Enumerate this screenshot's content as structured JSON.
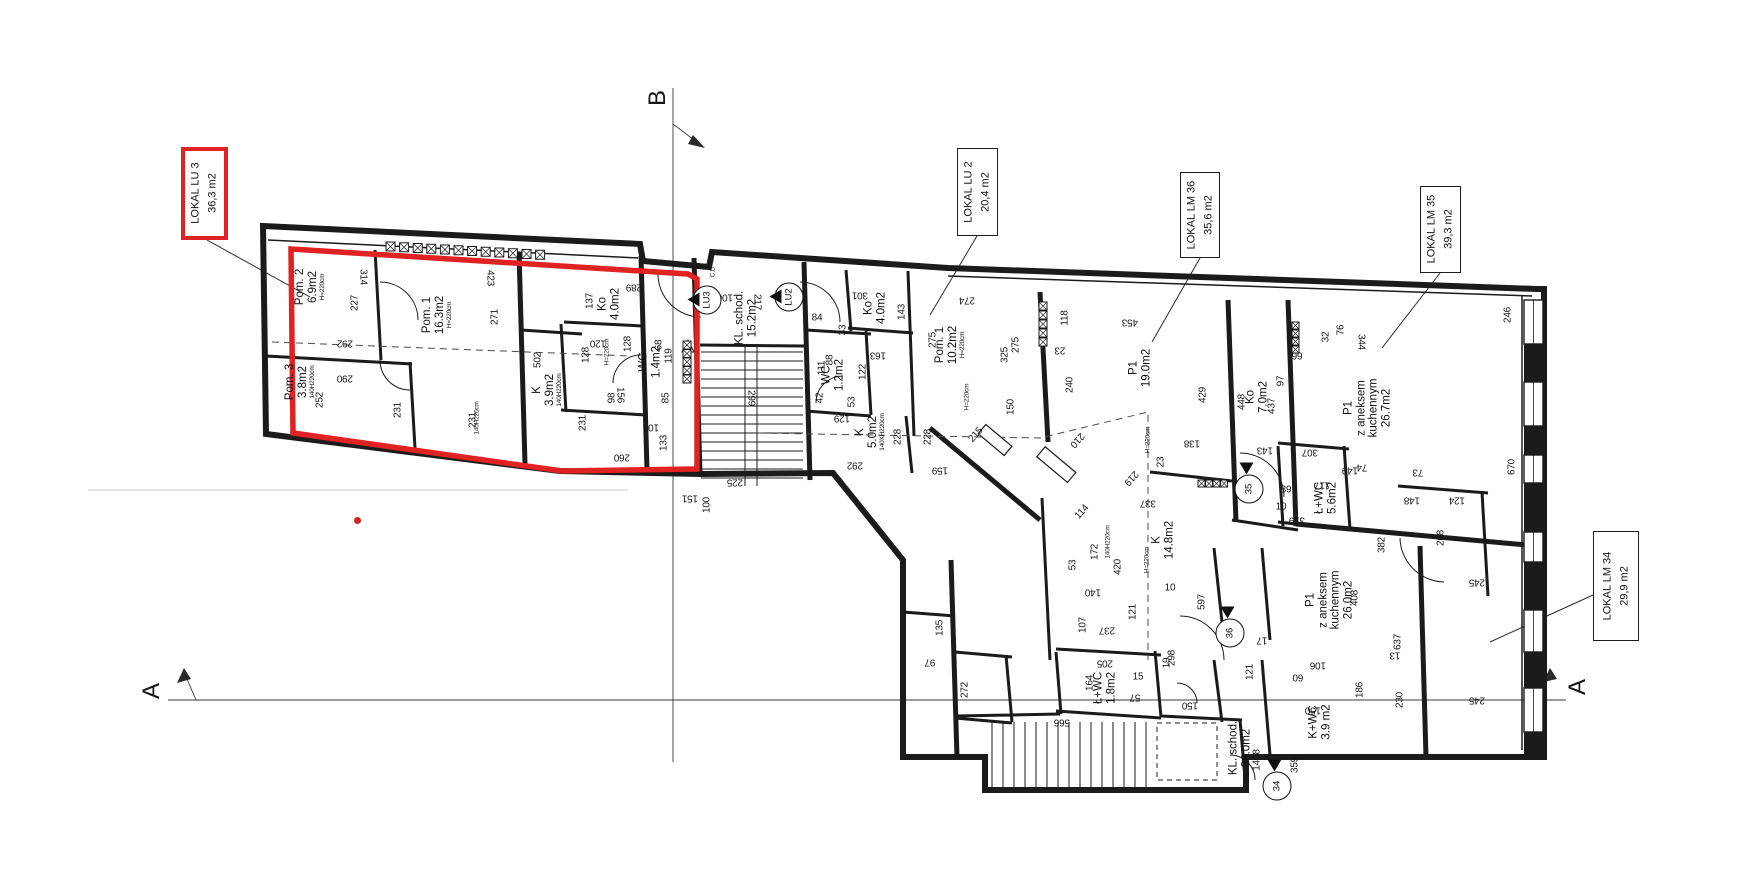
{
  "palette": {
    "line": "#1b1b1b",
    "red": "#e02222",
    "faint": "#c8c8c8"
  },
  "section_marks": {
    "top": "B",
    "left": "A",
    "right": "A"
  },
  "title_boxes": [
    {
      "id": "lu3",
      "lines": [
        "LOKAL LU 3",
        "36,3 m2"
      ],
      "x": 181,
      "y": 147,
      "w": 47,
      "h": 93,
      "red": true
    },
    {
      "id": "lu2",
      "lines": [
        "LOKAL LU 2",
        "20,4 m2"
      ],
      "x": 957,
      "y": 148,
      "w": 41,
      "h": 88,
      "red": false
    },
    {
      "id": "lm36",
      "lines": [
        "LOKAL LM 36",
        "35,6 m2"
      ],
      "x": 1180,
      "y": 172,
      "w": 40,
      "h": 86,
      "red": false
    },
    {
      "id": "lm35",
      "lines": [
        "LOKAL LM 35",
        "39,3 m2"
      ],
      "x": 1420,
      "y": 186,
      "w": 41,
      "h": 87,
      "red": false
    },
    {
      "id": "lm34",
      "lines": [
        "LOKAL LM 34",
        "29,9 m2"
      ],
      "x": 1593,
      "y": 531,
      "w": 46,
      "h": 110,
      "red": false
    }
  ],
  "rooms": [
    {
      "lines": [
        "Pom. 2",
        "6.9m2"
      ],
      "note": "H=220cm",
      "x": 310,
      "y": 287
    },
    {
      "lines": [
        "Pom. 1",
        "16.3m2"
      ],
      "note": "H=220cm",
      "x": 437,
      "y": 315
    },
    {
      "lines": [
        "Pom. 3",
        "3.8m2"
      ],
      "note": "140H220cm",
      "x": 300,
      "y": 382
    },
    {
      "lines": [
        "Ko",
        "4.0m2"
      ],
      "x": 609,
      "y": 304
    },
    {
      "lines": [
        "WC",
        "1.4m2"
      ],
      "x": 650,
      "y": 362
    },
    {
      "lines": [
        "K",
        "3.9m2"
      ],
      "note": "140H220cm",
      "x": 547,
      "y": 390
    },
    {
      "lines": [
        "KL. schod.",
        "15.2m2"
      ],
      "x": 746,
      "y": 318
    },
    {
      "lines": [
        "Ko",
        "4.0m2"
      ],
      "x": 875,
      "y": 308
    },
    {
      "lines": [
        "WC",
        "1.2m2"
      ],
      "x": 833,
      "y": 375
    },
    {
      "lines": [
        "K",
        "5.0m2"
      ],
      "note": "140XH220cm",
      "x": 870,
      "y": 432
    },
    {
      "lines": [
        "Pom. 1",
        "10.2m2"
      ],
      "note": "H=220cm",
      "x": 950,
      "y": 345
    },
    {
      "lines": [
        "P1",
        "19.0m2"
      ],
      "x": 1140,
      "y": 368
    },
    {
      "lines": [
        "Ko",
        "7.0m2"
      ],
      "x": 1257,
      "y": 397
    },
    {
      "lines": [
        "P1",
        "z aneksem",
        "kuchennym",
        "26.7m2"
      ],
      "x": 1368,
      "y": 408
    },
    {
      "lines": [
        "K",
        "14.8m2"
      ],
      "x": 1163,
      "y": 540
    },
    {
      "lines": [
        "Ł+WC",
        "1.8m2"
      ],
      "x": 1105,
      "y": 688
    },
    {
      "lines": [
        "Ł+WC",
        "5.6m2"
      ],
      "x": 1326,
      "y": 498
    },
    {
      "lines": [
        "KL. schod.",
        "36.0m2"
      ],
      "x": 1240,
      "y": 748
    },
    {
      "lines": [
        "P1",
        "z aneksem",
        "kuchennym",
        "26.0m2"
      ],
      "x": 1330,
      "y": 600
    },
    {
      "lines": [
        "K+WC",
        "3.9 m2"
      ],
      "x": 1320,
      "y": 722
    }
  ],
  "markers": [
    {
      "label": "LU3",
      "x": 707,
      "y": 300,
      "tri": "left"
    },
    {
      "label": "LU2",
      "x": 789,
      "y": 297,
      "tri": "left"
    },
    {
      "label": "35",
      "x": 1249,
      "y": 489,
      "tri": "top"
    },
    {
      "label": "36",
      "x": 1230,
      "y": 633,
      "tri": "top"
    },
    {
      "label": "34",
      "x": 1277,
      "y": 786,
      "tri": "top"
    }
  ],
  "dims": [
    {
      "v": "314",
      "x": 363,
      "y": 277,
      "r": 90
    },
    {
      "v": "423",
      "x": 490,
      "y": 278,
      "r": 90
    },
    {
      "v": "227",
      "x": 355,
      "y": 303,
      "r": -90
    },
    {
      "v": "292",
      "x": 345,
      "y": 343,
      "r": 180
    },
    {
      "v": "290",
      "x": 345,
      "y": 378,
      "r": 180
    },
    {
      "v": "252",
      "x": 320,
      "y": 400,
      "r": -90
    },
    {
      "v": "231",
      "x": 398,
      "y": 410,
      "r": -90
    },
    {
      "v": "231",
      "x": 473,
      "y": 420,
      "r": -90
    },
    {
      "v": "231",
      "x": 583,
      "y": 423,
      "r": -90
    },
    {
      "v": "271",
      "x": 495,
      "y": 317,
      "r": -90
    },
    {
      "v": "502",
      "x": 538,
      "y": 360,
      "r": -90
    },
    {
      "v": "137",
      "x": 590,
      "y": 301,
      "r": -90
    },
    {
      "v": "128",
      "x": 586,
      "y": 355,
      "r": -90
    },
    {
      "v": "128",
      "x": 628,
      "y": 344,
      "r": -90
    },
    {
      "v": "120",
      "x": 598,
      "y": 343,
      "r": 180
    },
    {
      "v": "289",
      "x": 634,
      "y": 287,
      "r": 180
    },
    {
      "v": "68",
      "x": 659,
      "y": 345,
      "r": -90
    },
    {
      "v": "119",
      "x": 669,
      "y": 356,
      "r": -90
    },
    {
      "v": "156",
      "x": 620,
      "y": 395,
      "r": 90
    },
    {
      "v": "98",
      "x": 612,
      "y": 398,
      "r": -90
    },
    {
      "v": "85",
      "x": 666,
      "y": 398,
      "r": -90
    },
    {
      "v": "104",
      "x": 651,
      "y": 427,
      "r": 180
    },
    {
      "v": "133",
      "x": 664,
      "y": 443,
      "r": -90
    },
    {
      "v": "260",
      "x": 622,
      "y": 457,
      "r": 180
    },
    {
      "v": "225",
      "x": 735,
      "y": 482,
      "r": 180
    },
    {
      "v": "151",
      "x": 690,
      "y": 498,
      "r": 180
    },
    {
      "v": "100",
      "x": 707,
      "y": 505,
      "r": -90
    },
    {
      "v": "299",
      "x": 751,
      "y": 398,
      "r": 90
    },
    {
      "v": "106",
      "x": 725,
      "y": 297,
      "r": 180
    },
    {
      "v": "217",
      "x": 757,
      "y": 302,
      "r": 90
    },
    {
      "v": "C,D",
      "x": 713,
      "y": 272,
      "r": -90,
      "s": 1
    },
    {
      "v": "84",
      "x": 817,
      "y": 318,
      "r": 0
    },
    {
      "v": "301",
      "x": 860,
      "y": 295,
      "r": 180
    },
    {
      "v": "143",
      "x": 902,
      "y": 312,
      "r": -90
    },
    {
      "v": "33",
      "x": 843,
      "y": 330,
      "r": -90
    },
    {
      "v": "88",
      "x": 830,
      "y": 360,
      "r": -90
    },
    {
      "v": "111",
      "x": 822,
      "y": 368,
      "r": -90
    },
    {
      "v": "122",
      "x": 863,
      "y": 372,
      "r": -90
    },
    {
      "v": "163",
      "x": 878,
      "y": 355,
      "r": 180
    },
    {
      "v": "42",
      "x": 820,
      "y": 398,
      "r": -90
    },
    {
      "v": "53",
      "x": 852,
      "y": 402,
      "r": -90
    },
    {
      "v": "129",
      "x": 842,
      "y": 418,
      "r": 180
    },
    {
      "v": "150",
      "x": 1011,
      "y": 407,
      "r": -90
    },
    {
      "v": "228",
      "x": 898,
      "y": 437,
      "r": -90
    },
    {
      "v": "228",
      "x": 928,
      "y": 437,
      "r": -90
    },
    {
      "v": "292",
      "x": 855,
      "y": 465,
      "r": 180
    },
    {
      "v": "275",
      "x": 933,
      "y": 340,
      "r": -90
    },
    {
      "v": "275",
      "x": 1016,
      "y": 345,
      "r": -90
    },
    {
      "v": "274",
      "x": 967,
      "y": 300,
      "r": 180
    },
    {
      "v": "325",
      "x": 1005,
      "y": 355,
      "r": -90
    },
    {
      "v": "215",
      "x": 976,
      "y": 435,
      "r": -48
    },
    {
      "v": "240",
      "x": 1070,
      "y": 385,
      "r": -90
    },
    {
      "v": "210",
      "x": 1077,
      "y": 440,
      "r": 132
    },
    {
      "v": "118",
      "x": 1065,
      "y": 318,
      "r": -90
    },
    {
      "v": "23",
      "x": 1060,
      "y": 350,
      "r": 180
    },
    {
      "v": "159",
      "x": 940,
      "y": 470,
      "r": 180
    },
    {
      "v": "453",
      "x": 1130,
      "y": 322,
      "r": 180
    },
    {
      "v": "429",
      "x": 1203,
      "y": 395,
      "r": -90
    },
    {
      "v": "138",
      "x": 1192,
      "y": 443,
      "r": 180
    },
    {
      "v": "23",
      "x": 1161,
      "y": 462,
      "r": -90
    },
    {
      "v": "219",
      "x": 1131,
      "y": 478,
      "r": 132
    },
    {
      "v": "448",
      "x": 1242,
      "y": 402,
      "r": -90
    },
    {
      "v": "437",
      "x": 1272,
      "y": 406,
      "r": -90
    },
    {
      "v": "97",
      "x": 1281,
      "y": 381,
      "r": -90
    },
    {
      "v": "143",
      "x": 1265,
      "y": 450,
      "r": 180
    },
    {
      "v": "99",
      "x": 1297,
      "y": 357,
      "r": 0
    },
    {
      "v": "32",
      "x": 1326,
      "y": 337,
      "r": -90
    },
    {
      "v": "76",
      "x": 1341,
      "y": 330,
      "r": -90
    },
    {
      "v": "344",
      "x": 1361,
      "y": 342,
      "r": 90
    },
    {
      "v": "114",
      "x": 1082,
      "y": 512,
      "r": -48
    },
    {
      "v": "172",
      "x": 1095,
      "y": 552,
      "r": -90
    },
    {
      "v": "420",
      "x": 1118,
      "y": 567,
      "r": -90
    },
    {
      "v": "140",
      "x": 1093,
      "y": 592,
      "r": 180
    },
    {
      "v": "53",
      "x": 1073,
      "y": 565,
      "r": -90
    },
    {
      "v": "107",
      "x": 1083,
      "y": 625,
      "r": -90
    },
    {
      "v": "237",
      "x": 1107,
      "y": 630,
      "r": 180
    },
    {
      "v": "121",
      "x": 1133,
      "y": 612,
      "r": -90
    },
    {
      "v": "337",
      "x": 1148,
      "y": 503,
      "r": 180
    },
    {
      "v": "597",
      "x": 1202,
      "y": 602,
      "r": -90
    },
    {
      "v": "10",
      "x": 1170,
      "y": 588,
      "r": 0
    },
    {
      "v": "19",
      "x": 1167,
      "y": 663,
      "r": -90
    },
    {
      "v": "298",
      "x": 1172,
      "y": 658,
      "r": -90
    },
    {
      "v": "205",
      "x": 1105,
      "y": 663,
      "r": 180
    },
    {
      "v": "164",
      "x": 1090,
      "y": 683,
      "r": -90
    },
    {
      "v": "15",
      "x": 1138,
      "y": 677,
      "r": 0
    },
    {
      "v": "57",
      "x": 1135,
      "y": 697,
      "r": 180
    },
    {
      "v": "150",
      "x": 1190,
      "y": 705,
      "r": 180
    },
    {
      "v": "121",
      "x": 1250,
      "y": 672,
      "r": -90
    },
    {
      "v": "17",
      "x": 1262,
      "y": 640,
      "r": 180
    },
    {
      "v": "106",
      "x": 1318,
      "y": 665,
      "r": 180
    },
    {
      "v": "60",
      "x": 1298,
      "y": 677,
      "r": 180
    },
    {
      "v": "150",
      "x": 1313,
      "y": 710,
      "r": 180
    },
    {
      "v": "359",
      "x": 1295,
      "y": 765,
      "r": -90
    },
    {
      "v": "1408",
      "x": 1257,
      "y": 760,
      "r": -90
    },
    {
      "v": "135",
      "x": 940,
      "y": 628,
      "r": -90
    },
    {
      "v": "97",
      "x": 930,
      "y": 662,
      "r": 180
    },
    {
      "v": "272",
      "x": 965,
      "y": 690,
      "r": -90
    },
    {
      "v": "566",
      "x": 1062,
      "y": 722,
      "r": 180
    },
    {
      "v": "246",
      "x": 1508,
      "y": 315,
      "r": -90
    },
    {
      "v": "670",
      "x": 1512,
      "y": 467,
      "r": -90
    },
    {
      "v": "73",
      "x": 1418,
      "y": 472,
      "r": 180
    },
    {
      "v": "148",
      "x": 1412,
      "y": 500,
      "r": 180
    },
    {
      "v": "124",
      "x": 1457,
      "y": 500,
      "r": 180
    },
    {
      "v": "268",
      "x": 1441,
      "y": 538,
      "r": -90
    },
    {
      "v": "245",
      "x": 1477,
      "y": 582,
      "r": 180
    },
    {
      "v": "245",
      "x": 1477,
      "y": 700,
      "r": 180
    },
    {
      "v": "307",
      "x": 1310,
      "y": 452,
      "r": 180
    },
    {
      "v": "149",
      "x": 1350,
      "y": 470,
      "r": 180
    },
    {
      "v": "117",
      "x": 1322,
      "y": 485,
      "r": 180
    },
    {
      "v": "74",
      "x": 1362,
      "y": 467,
      "r": 180
    },
    {
      "v": "89",
      "x": 1286,
      "y": 490,
      "r": 0
    },
    {
      "v": "10",
      "x": 1281,
      "y": 507,
      "r": 0
    },
    {
      "v": "319",
      "x": 1297,
      "y": 520,
      "r": 180
    },
    {
      "v": "382",
      "x": 1382,
      "y": 545,
      "r": -90
    },
    {
      "v": "408",
      "x": 1355,
      "y": 598,
      "r": -90
    },
    {
      "v": "637",
      "x": 1398,
      "y": 642,
      "r": -90
    },
    {
      "v": "13",
      "x": 1395,
      "y": 655,
      "r": 180
    },
    {
      "v": "186",
      "x": 1360,
      "y": 690,
      "r": -90
    },
    {
      "v": "230",
      "x": 1400,
      "y": 700,
      "r": -90
    },
    {
      "v": "H=220cm",
      "x": 967,
      "y": 397,
      "r": -90,
      "s": 1
    },
    {
      "v": "H=220cm",
      "x": 1148,
      "y": 440,
      "r": -90,
      "s": 1
    },
    {
      "v": "H=220cm",
      "x": 1147,
      "y": 560,
      "r": -90,
      "s": 1
    },
    {
      "v": "140H220cm",
      "x": 1108,
      "y": 542,
      "r": -90,
      "s": 1
    },
    {
      "v": "H=220cm",
      "x": 607,
      "y": 352,
      "r": -90,
      "s": 1
    },
    {
      "v": "140H220cm",
      "x": 477,
      "y": 418,
      "r": -90,
      "s": 1
    }
  ]
}
